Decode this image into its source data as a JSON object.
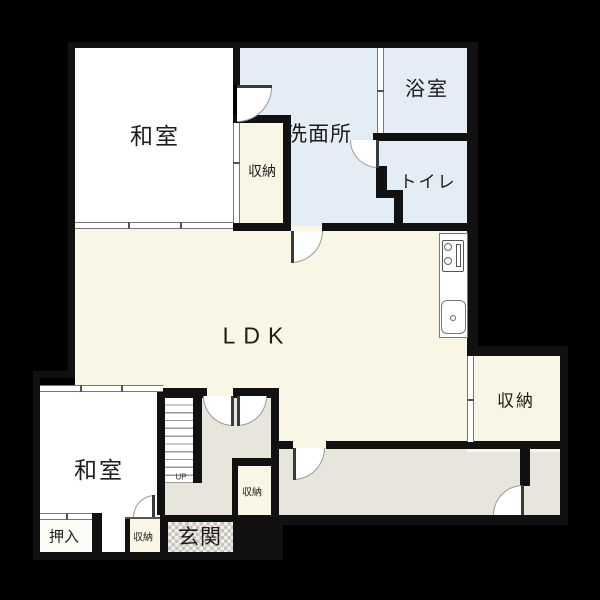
{
  "title": "floor-plan",
  "rooms": [
    {
      "id": "washitsu-upper",
      "label": "和室"
    },
    {
      "id": "senmenjo",
      "label": "洗面所"
    },
    {
      "id": "yokushitsu",
      "label": "浴室"
    },
    {
      "id": "toire",
      "label": "トイレ"
    },
    {
      "id": "shuno-upper",
      "label": "収納"
    },
    {
      "id": "ldk",
      "label": "LDK"
    },
    {
      "id": "shuno-right",
      "label": "収納"
    },
    {
      "id": "washitsu-lower",
      "label": "和室"
    },
    {
      "id": "oshiire",
      "label": "押入"
    },
    {
      "id": "shuno-lower-small",
      "label": "収納"
    },
    {
      "id": "genkan",
      "label": "玄関"
    },
    {
      "id": "shuno-hallway",
      "label": "収納"
    }
  ],
  "stairs": {
    "direction_label": "UP"
  },
  "colors": {
    "background": "#000000",
    "wall": "#111111",
    "room_white": "#ffffff",
    "room_cream": "#faf6e6",
    "wet_area_blue": "#e4edf5",
    "hallway_gray": "#e8e5dd",
    "genkan_check": "#c6c4bd"
  }
}
